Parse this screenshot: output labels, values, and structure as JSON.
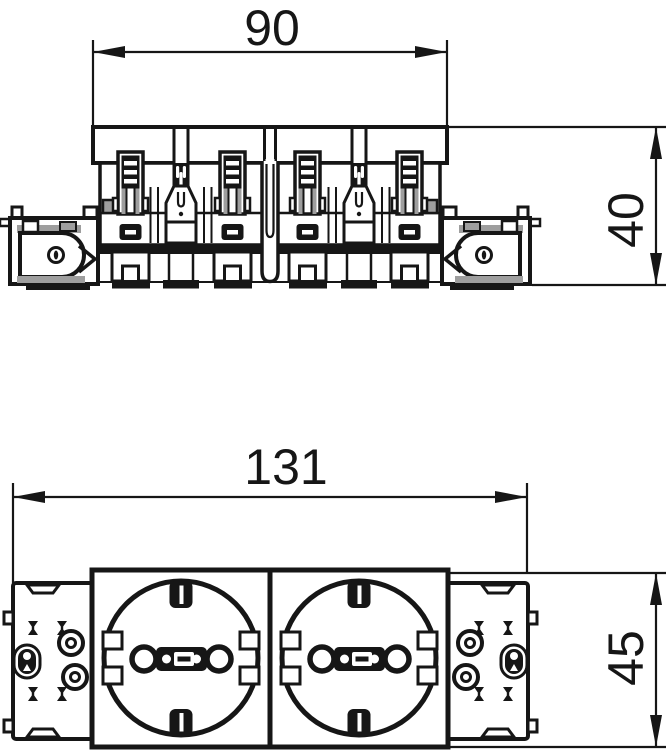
{
  "drawing": {
    "background": "#ffffff",
    "line_color": "#161616",
    "shade_color": "#9e9e9e",
    "top_view": {
      "width_label": "90",
      "height_label": "40"
    },
    "front_view": {
      "width_label": "131",
      "height_label": "45"
    }
  }
}
